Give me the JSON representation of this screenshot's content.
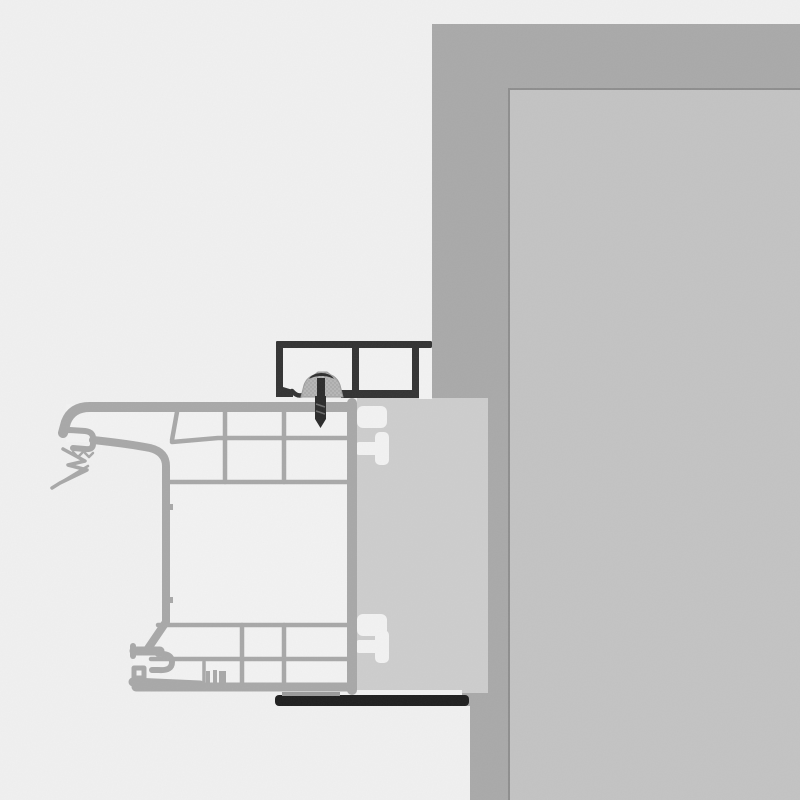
{
  "title": "",
  "canvas": {
    "width": 800,
    "height": 800
  },
  "colors": {
    "background": "#f0f0f0",
    "wall_outer": "#a9a9a9",
    "wall_inner": "#c3c3c3",
    "wall_inner_border": "#8e8e8e",
    "profile_line": "#a8a8a8",
    "profile_fill": "#f2f2f2",
    "panel": "#cdcdcd",
    "cover_profile_dark": "#333333",
    "base_trim_dark": "#1f1f1f",
    "clamp_fill": "#b6b6b6",
    "clamp_dot": "#9c9c9c",
    "washer_dark": "#2e2e2e",
    "screw_dark": "#2b2b2b",
    "thread_light": "#6b6b6b",
    "seal_gray": "#9b9b9b"
  },
  "parts": {
    "wall": "wall",
    "wall_opening": "wall-opening",
    "mounting_panel": "mounting-panel",
    "frame_profile": "window-frame-profile",
    "cover_profile": "exterior-cover-profile",
    "mounting_clamp": "fixing-clamp",
    "fixing_screw": "fixing-screw",
    "glazing_gasket": "gasket",
    "base_trim": "base-trim-bar",
    "t_slot": "t-slot-channel"
  }
}
